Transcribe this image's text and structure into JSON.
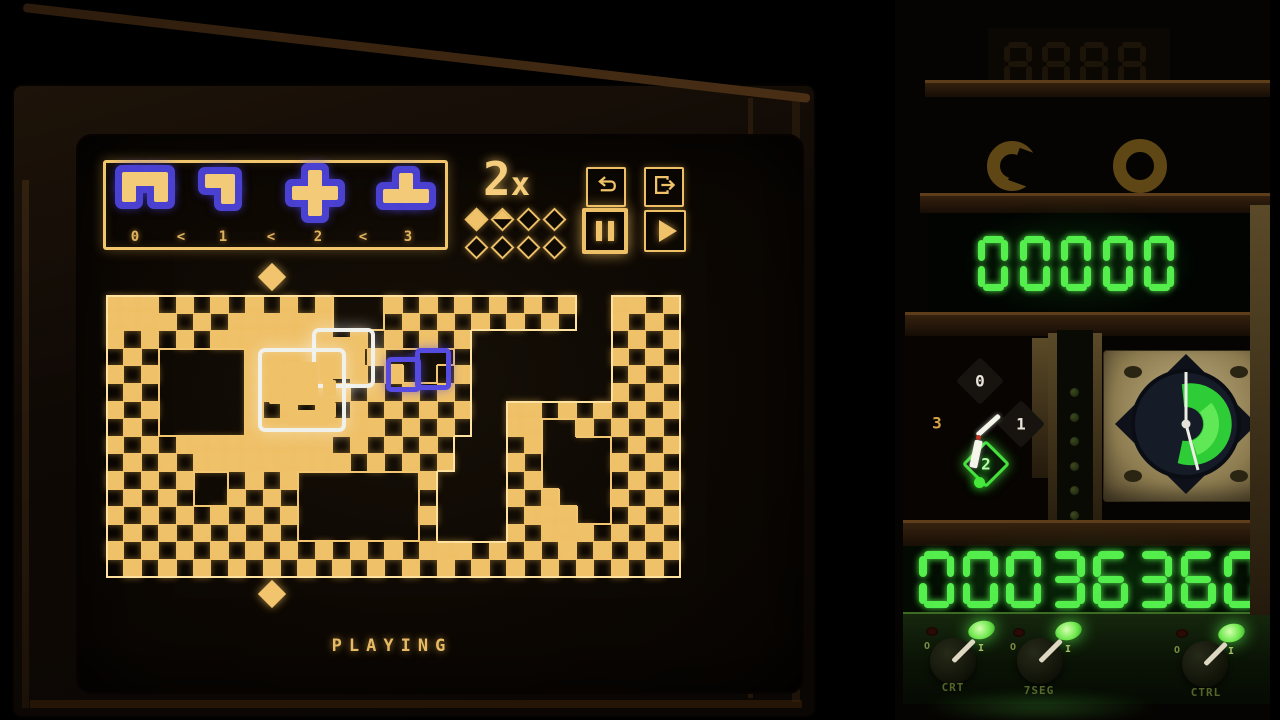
{
  "screen": {
    "status_text": "PLAYING",
    "speed_label_number": "2",
    "speed_label_x": "x",
    "inventory": {
      "labels": [
        "0",
        "1",
        "2",
        "3"
      ],
      "separator": "<",
      "pieces": [
        {
          "name": "arch",
          "cells": [
            [
              0,
              0
            ],
            [
              1,
              0
            ],
            [
              2,
              0
            ],
            [
              0,
              1
            ],
            [
              2,
              1
            ]
          ]
        },
        {
          "name": "seven",
          "cells": [
            [
              0,
              0
            ],
            [
              1,
              0
            ],
            [
              1,
              1
            ]
          ]
        },
        {
          "name": "plus",
          "cells": [
            [
              1,
              0
            ],
            [
              0,
              1
            ],
            [
              1,
              1
            ],
            [
              2,
              1
            ],
            [
              1,
              2
            ]
          ]
        },
        {
          "name": "tee",
          "cells": [
            [
              1,
              0
            ],
            [
              0,
              1
            ],
            [
              1,
              1
            ],
            [
              2,
              1
            ]
          ]
        }
      ]
    },
    "progress_pips": [
      "filled",
      "half",
      "empty",
      "empty",
      "empty",
      "empty",
      "empty",
      "empty"
    ],
    "buttons": {
      "items": [
        {
          "id": "undo",
          "icon": "undo-loop-icon"
        },
        {
          "id": "redo",
          "icon": "box-arrow-right-icon"
        },
        {
          "id": "pause",
          "icon": "pause-icon",
          "active": true
        },
        {
          "id": "play",
          "icon": "play-icon"
        }
      ]
    },
    "map": {
      "cols": 33,
      "rows": 16,
      "legend": {
        ".": "outside",
        "c": "checker",
        "s": "solid",
        "h": "hole"
      },
      "grid": [
        "ssscccccccccchhhccccccccccc..sscc",
        "sssccccsssssshhhccccccccccc..cccc",
        "cccccccsssssscccccccc........cccc",
        "ccchhhhhsssssccchhhhc........cccc",
        "ccchhhhhssssscccchhcc........cccc",
        "ccchhhhhssssscccccccc........cccc",
        "ccchhhhhccccccccccccc..sscccccccc",
        "ccchhhhhssssssscccccc..sshhcccccc",
        "cccccssssssssccccccc...cchhhhcccc",
        "cccccssssssssccccccc...cchhhhcccc",
        "ccccchhcccchhhhhhhc....cchhhhcccc",
        "ccccchhcccchhhhhhhc....ccshhhcccc",
        "ccccccccccchhhhhhhc....ccsshhcccc",
        "ccccccccccchhhhhhhc....cccssccccc",
        "cccccccccccccccccccsscccccccccccc",
        "ccccccccccccccccccccccccccccccccc"
      ]
    },
    "overlays": {
      "white_piece": "current-piece",
      "blue_piece": "ghost-piece"
    },
    "markers": [
      "top-diamond",
      "bottom-diamond"
    ]
  },
  "panel": {
    "unlit_display": "8888",
    "small_display": "00000",
    "large_display": "00036360",
    "dial": {
      "labels": [
        "0",
        "1",
        "2",
        "3"
      ],
      "selected": "2"
    },
    "led_count": 8,
    "switches": [
      {
        "label": "CRT",
        "off": "O",
        "on": "I",
        "state": "on"
      },
      {
        "label": "7SEG",
        "off": "O",
        "on": "I",
        "state": "on"
      },
      {
        "label": "CTRL",
        "off": "O",
        "on": "I",
        "state": "on"
      }
    ]
  },
  "colors": {
    "amber": "#efc169",
    "amber_bright": "#ffe2a0",
    "blue": "#564be0",
    "white": "#f1f1ec",
    "seg_green": "#54ee4d",
    "dial_green": "#45e03c"
  }
}
